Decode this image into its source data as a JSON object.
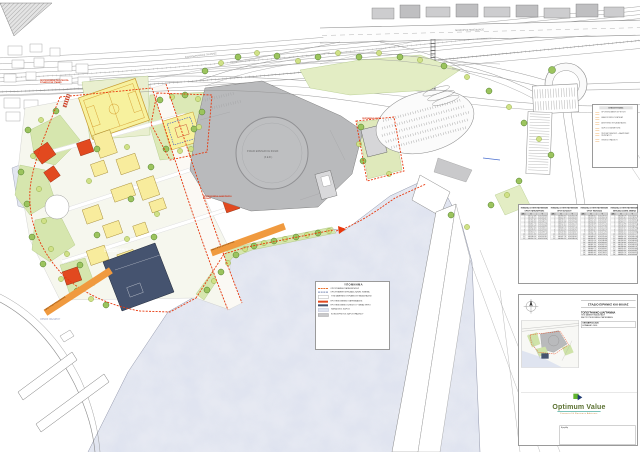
{
  "map": {
    "stadium_label_1": "ΣΤΑΔΙΟ ΕΙΡΗΝΗΣ ΚΑΙ ΦΙΛΙΑΣ",
    "stadium_label_2": "(Σ.Ε.Φ.)",
    "road_label_top": "ΛΕΩΦΟΡΟΣ ΠΟΣΕΙΔΩΝΟΣ",
    "road_label_rail": "ΣΙΔΗΡΟΔΡΟΜΙΚΕΣ ΓΡΑΜΜΕΣ",
    "sea_label": "ΟΡΜΟΣ ΦΑΛΗΡΟΥ",
    "annotations": {
      "bridge": "ΠΡΟΤΕΙΝΟΜΕΝΗ ΠΕΖΟΓΕΦΥΡΑ ΣΥΝΔΕΣΗΣ ΜΕ ΣΤΑΘΜΟ",
      "entrance": "ΠΡΟΤΕΙΝΟΜΕΝΗ ΔΙΑΜΟΡΦΩΣΗ ΕΙΣΟΔΟΥ",
      "gym": "ΠΡΟΤΕΙΝΟΜΕΝΟ ΚΛΕΙΣΤΟ ΓΥΜΝΑΣΤΗΡΙΟ",
      "existing": "ΥΦΙΣΤΑΜΕΝΟ ΚΤΙΡΙΟ",
      "chip_waterfront": "ΟΔΟΣ ΗΠΙΑΣ ΚΥΚΛΟΦΟΡΙΑΣ",
      "chip_coast": "ΟΔΟΣ ΗΠΙΑΣ ΚΥΚΛΟΦΟΡΙΑΣ"
    }
  },
  "interventions_panel": {
    "title": "ΕΠΕΞΗΓΗΣΕΙΣ",
    "items": [
      {
        "label": "ΠΡΟΤΕΙΝΟΜΕΝΗ ΦΥΤΕΥΣΗ"
      },
      {
        "label": "ΔΙΑΜΟΡΦΩΣΗ ΠΛΑΤΕΙΑΣ"
      },
      {
        "label": "ΑΘΛΗΤΙΚΕΣ ΕΓΚΑΤΑΣΤΑΣΕΙΣ"
      },
      {
        "label": "ΧΩΡΟΣ ΣΤΑΘΜΕΥΣΗΣ"
      },
      {
        "label": "ΠΕΖΟΔΡΟΜΗΣΕΙΣ - ΔΙΑΔΡΟΜΕΣ ΠΕΡΙΠΑΤΟΥ"
      },
      {
        "label": "ΘΕΣΕΙΣ ΠΡΑΣΙΝΟΥ"
      }
    ]
  },
  "legend": {
    "title": "ΥΠΟΜΝΗΜΑ",
    "items": [
      {
        "swatch": "sw-dash-orange",
        "label": "ΟΡΙΟΓΡΑΜΜΗ ΠΑΡΑΧΩΡΗΣΗΣ"
      },
      {
        "swatch": "sw-dash-blue",
        "label": "ΟΡΙΟΓΡΑΜΜΗ ΧΕΡΣΑΙΑΣ ΖΩΝΗΣ ΛΙΜΕΝΑ"
      },
      {
        "swatch": "sw-box-white",
        "label": "ΥΦΙΣΤΑΜΕΝΕΣ ΚΤΙΡΙΑΚΕΣ ΕΓΚΑΤΑΣΤΑΣΕΙΣ"
      },
      {
        "swatch": "sw-bar-orange",
        "label": "ΠΡΟΤΕΙΝΟΜΕΝΕΣ ΠΑΡΕΜΒΑΣΕΙΣ"
      },
      {
        "swatch": "sw-bar-navy",
        "label": "ΠΡΟΤΕΙΝΟΜΕΝΟ ΚΛΕΙΣΤΟ ΓΥΜΝΑΣΤΗΡΙΟ"
      },
      {
        "swatch": "sw-box-sea",
        "label": "ΘΑΛΑΣΣΙΟΣ ΧΩΡΟΣ"
      },
      {
        "swatch": "sw-box-grey",
        "label": "ΚΟΙΝΟΧΡΗΣΤΟΙ ΧΩΡΟΙ ΠΡΑΣΙΝΟΥ"
      }
    ]
  },
  "coordinate_tables": {
    "headers": [
      "Α/Α",
      "Χ",
      "Υ"
    ],
    "t1": {
      "title": "ΠΙΝΑΚΑΣ ΣΥΝΤΕΤΑΓΜΕΝΩΝ",
      "subtitle": "ΟΡΙΟΥ ΠΑΡΑΧΩΡΗΣΗΣ",
      "rows": [
        [
          "1",
          "465712.48",
          "4202318.64"
        ],
        [
          "2",
          "465739.12",
          "4202341.07"
        ],
        [
          "3",
          "465761.85",
          "4202366.93"
        ],
        [
          "4",
          "465780.34",
          "4202395.21"
        ],
        [
          "5",
          "465801.76",
          "4202421.58"
        ],
        [
          "6",
          "465826.09",
          "4202444.86"
        ],
        [
          "7",
          "465852.43",
          "4202463.12"
        ],
        [
          "8",
          "465878.91",
          "4202479.35"
        ],
        [
          "9",
          "465903.27",
          "4202498.74"
        ],
        [
          "10",
          "465921.66",
          "4202522.09"
        ],
        [
          "11",
          "465938.14",
          "4202547.81"
        ],
        [
          "12",
          "465952.70",
          "4202574.26"
        ]
      ]
    },
    "t2": {
      "title": "ΠΙΝΑΚΑΣ ΣΥΝΤΕΤΑΓΜΕΝΩΝ",
      "subtitle": "ΟΡΙΟΥ ΑΙΓΙΑΛΟΥ",
      "rows": [
        [
          "1",
          "465984.35",
          "4202301.18"
        ],
        [
          "2",
          "466002.87",
          "4202326.45"
        ],
        [
          "3",
          "466019.52",
          "4202352.90"
        ],
        [
          "4",
          "466035.08",
          "4202379.66"
        ],
        [
          "5",
          "466052.41",
          "4202405.13"
        ],
        [
          "6",
          "466070.96",
          "4202429.71"
        ],
        [
          "7",
          "466088.23",
          "4202455.38"
        ],
        [
          "8",
          "466104.59",
          "4202481.92"
        ],
        [
          "9",
          "466119.84",
          "4202508.47"
        ],
        [
          "10",
          "466133.30",
          "4202536.05"
        ],
        [
          "11",
          "466147.78",
          "4202562.61"
        ],
        [
          "12",
          "466160.25",
          "4202589.14"
        ]
      ]
    },
    "t3": {
      "title": "ΠΙΝΑΚΑΣ ΣΥΝΤΕΤΑΓΜΕΝΩΝ",
      "subtitle": "ΟΡΙΟΥ ΠΑΡΑΛΙΑΣ",
      "rows": [
        [
          "1",
          "466188.41",
          "4202287.52"
        ],
        [
          "2",
          "466203.76",
          "4202309.18"
        ],
        [
          "3",
          "466221.34",
          "4202331.85"
        ],
        [
          "4",
          "466240.02",
          "4202353.47"
        ],
        [
          "5",
          "466258.69",
          "4202375.10"
        ],
        [
          "6",
          "466276.15",
          "4202397.84"
        ],
        [
          "7",
          "466292.83",
          "4202421.56"
        ],
        [
          "8",
          "466308.47",
          "4202446.29"
        ],
        [
          "9",
          "466322.90",
          "4202471.93"
        ],
        [
          "10",
          "466336.18",
          "4202498.35"
        ],
        [
          "11",
          "466348.52",
          "4202525.40"
        ],
        [
          "12",
          "466359.87",
          "4202552.96"
        ],
        [
          "13",
          "466370.14",
          "4202580.88"
        ],
        [
          "14",
          "466379.36",
          "4202609.02"
        ],
        [
          "15",
          "466387.55",
          "4202637.25"
        ],
        [
          "16",
          "466394.68",
          "4202665.43"
        ],
        [
          "17",
          "466400.71",
          "4202693.41"
        ],
        [
          "18",
          "466405.63",
          "4202721.05"
        ],
        [
          "19",
          "466409.42",
          "4202748.21"
        ],
        [
          "20",
          "466412.06",
          "4202774.75"
        ]
      ]
    },
    "t4": {
      "title": "ΠΙΝΑΚΑΣ ΣΥΝΤΕΤΑΓΜΕΝΩΝ",
      "subtitle": "ΧΕΡΣΑΙΑΣ ΖΩΝΗΣ ΛΙΜΕΝΑ",
      "rows": [
        [
          "1",
          "466438.19",
          "4202264.37"
        ],
        [
          "2",
          "466455.82",
          "4202286.90"
        ],
        [
          "3",
          "466474.53",
          "4202308.61"
        ],
        [
          "4",
          "466494.27",
          "4202329.44"
        ],
        [
          "5",
          "466514.98",
          "4202349.32"
        ],
        [
          "6",
          "466536.60",
          "4202368.19"
        ],
        [
          "7",
          "466559.07",
          "4202385.98"
        ],
        [
          "8",
          "466582.33",
          "4202402.63"
        ],
        [
          "9",
          "466606.31",
          "4202418.08"
        ],
        [
          "10",
          "466630.94",
          "4202432.27"
        ],
        [
          "11",
          "466656.16",
          "4202445.14"
        ],
        [
          "12",
          "466681.90",
          "4202456.63"
        ],
        [
          "13",
          "466708.09",
          "4202466.69"
        ],
        [
          "14",
          "466734.66",
          "4202475.27"
        ],
        [
          "15",
          "466761.54",
          "4202482.32"
        ],
        [
          "16",
          "466788.66",
          "4202487.79"
        ],
        [
          "17",
          "466815.95",
          "4202491.64"
        ],
        [
          "18",
          "466843.34",
          "4202493.83"
        ],
        [
          "19",
          "466870.76",
          "4202494.32"
        ],
        [
          "20",
          "466898.14",
          "4202493.08"
        ]
      ]
    }
  },
  "title_block": {
    "project_title": "ΣΤΑΔΙΟ ΕΙΡΗΝΗΣ ΚΑΙ ΦΙΛΙΑΣ",
    "drawing_title": "ΤΟΠΟΓΡΑΦΙΚΟ ΔΙΑΓΡΑΜΜΑ",
    "drawing_subtitle_1": "ΥΦΙΣΤΑΜΕΝΗ ΚΑΤΑΣΤΑΣΗ",
    "drawing_subtitle_2": "ΚΑΙ ΠΡΟΤΕΙΝΟΜΕΝΗ ΠΑΡΕΜΒΑΣΗ",
    "date": "ΟΚΤΩΒΡΙΟΣ 2020",
    "scale": "ΚΛΙΜΑΚΑ 1:1000",
    "logo_text": "Optimum Value",
    "logo_tagline": "Financial & Business Advisors",
    "approval_label": "Εγκρίθη"
  },
  "colors": {
    "accent_red": "#e8380d",
    "esplanade_grey": "#b9babc",
    "navy_building": "#45536f",
    "pitch_yellow": "#f7f19e",
    "orange_building": "#e2491f",
    "sea": "#e6e9f2",
    "green": "#d6e6ae"
  }
}
